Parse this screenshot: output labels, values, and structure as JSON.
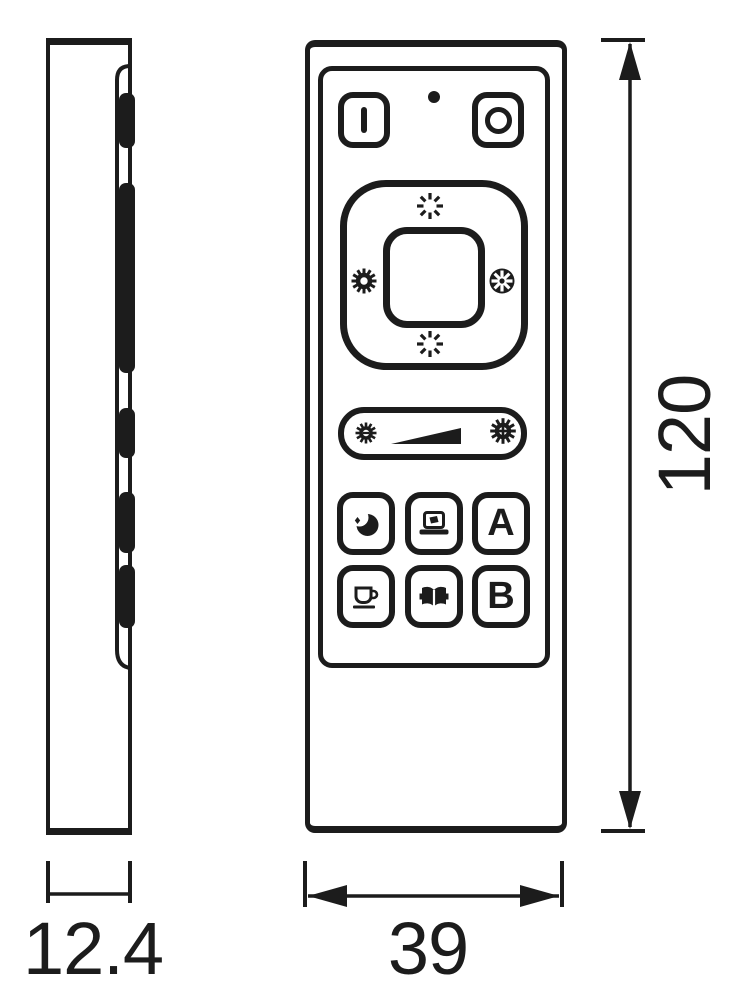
{
  "colors": {
    "ink": "#1c1c1c",
    "paper": "#ffffff"
  },
  "dimension_labels": {
    "height": "120",
    "width": "39",
    "depth": "12.4"
  },
  "remote": {
    "preset_a_label": "A",
    "preset_b_label": "B",
    "icons": {
      "power_on": "power-on-bar-icon",
      "power_off": "power-off-circle-icon",
      "status_led": "led-indicator",
      "dpad_up": "brightness-burst-icon",
      "dpad_down": "brightness-burst-icon",
      "dpad_left": "warm-sun-gear-icon",
      "dpad_right": "cool-snowflake-icon",
      "slider_dim": "sun-minus-icon",
      "slider_ramp": "brightness-ramp-icon",
      "slider_bright": "sun-plus-icon",
      "scene_night": "moon-icon",
      "scene_movie": "laptop-icon",
      "scene_coffee": "cup-icon",
      "scene_reading": "book-icon"
    }
  }
}
